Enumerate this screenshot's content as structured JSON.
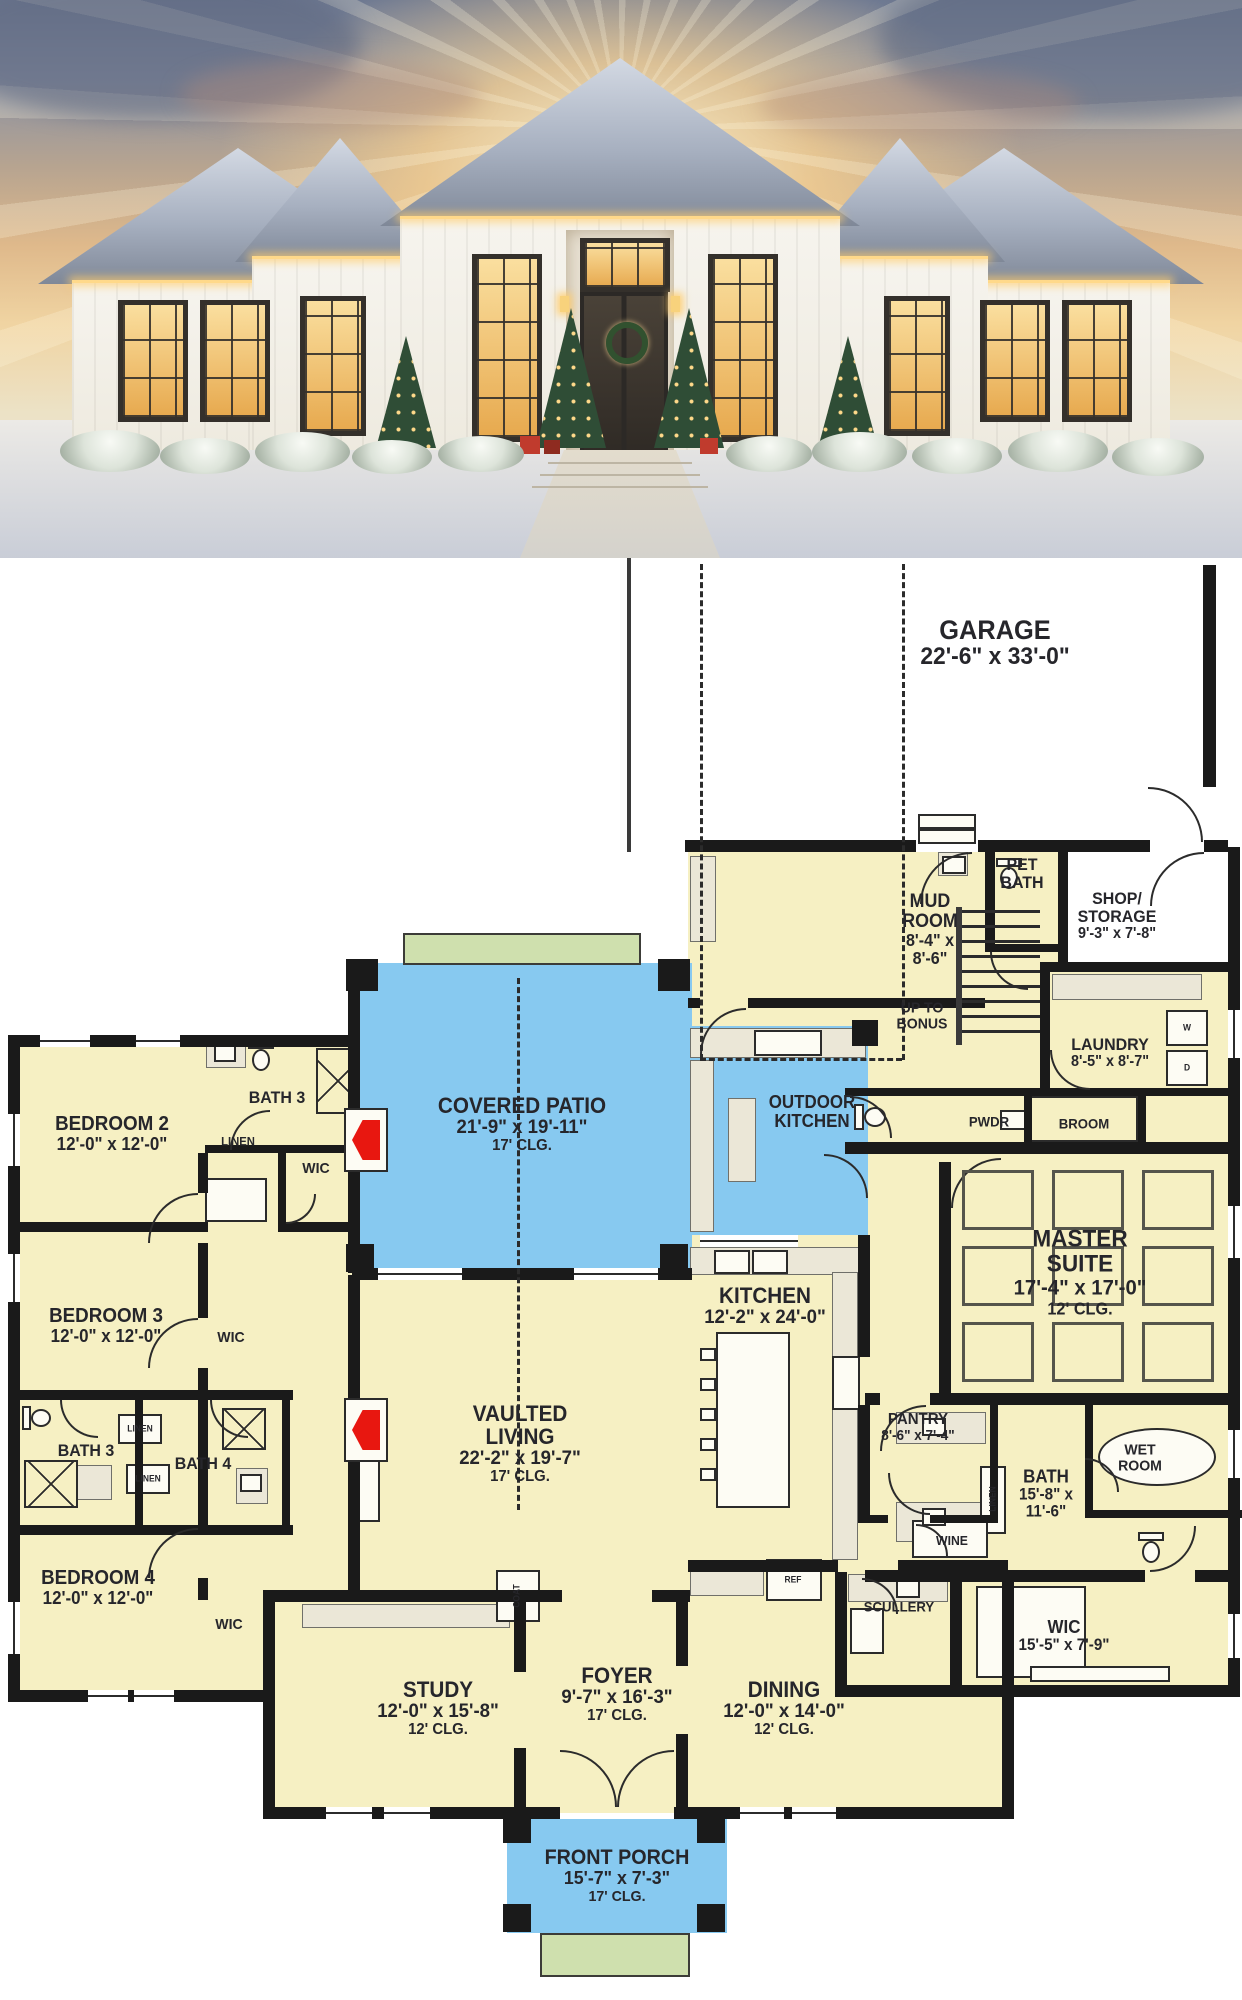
{
  "photo": {
    "alt": "snow-covered white modern farmhouse at sunset with glowing windows, roofline lights, christmas trees and snowy shrubs"
  },
  "plan": {
    "colors": {
      "room_fill": "#f6f0c3",
      "patio_fill": "#87c9f0",
      "steps_fill": "#cfe0ae",
      "wall": "#1a1a1a",
      "counter": "#ebe7d7",
      "fireplace_red": "#e81710",
      "label": "#26262b"
    },
    "room_labels": [
      {
        "id": "garage",
        "title": [
          "GARAGE"
        ],
        "dims": [
          "22'-6\" x 33'-0\""
        ],
        "clg": "",
        "x": 995,
        "y": 85,
        "fs": 27
      },
      {
        "id": "mud-room",
        "title": [
          "MUD",
          "ROOM"
        ],
        "dims": [
          "8'-4\" x",
          "8'-6\""
        ],
        "clg": "",
        "x": 930,
        "y": 372,
        "fs": 19
      },
      {
        "id": "pet-bath",
        "title": [
          "PET",
          "BATH"
        ],
        "dims": [],
        "clg": "",
        "x": 1022,
        "y": 316,
        "fs": 17
      },
      {
        "id": "shop-storage",
        "title": [
          "SHOP/",
          "STORAGE"
        ],
        "dims": [
          "9'-3\" x 7'-8\""
        ],
        "clg": "",
        "x": 1117,
        "y": 358,
        "fs": 17
      },
      {
        "id": "up-to-bonus",
        "title": [
          "UP TO",
          "BONUS"
        ],
        "dims": [],
        "clg": "",
        "x": 922,
        "y": 458,
        "fs": 15
      },
      {
        "id": "laundry",
        "title": [
          "LAUNDRY"
        ],
        "dims": [
          "8'-5\" x 8'-7\""
        ],
        "clg": "",
        "x": 1110,
        "y": 495,
        "fs": 17
      },
      {
        "id": "pwdr",
        "title": [
          "PWDR"
        ],
        "dims": [],
        "clg": "",
        "x": 989,
        "y": 564,
        "fs": 14
      },
      {
        "id": "broom",
        "title": [
          "BROOM"
        ],
        "dims": [],
        "clg": "",
        "x": 1084,
        "y": 566,
        "fs": 14
      },
      {
        "id": "master-suite",
        "title": [
          "MASTER",
          "SUITE"
        ],
        "dims": [
          "17'-4\" x 17'-0\""
        ],
        "clg": "12' CLG.",
        "x": 1080,
        "y": 714,
        "fs": 24
      },
      {
        "id": "outdoor-kitchen",
        "title": [
          "OUTDOOR",
          "KITCHEN"
        ],
        "dims": [],
        "clg": "",
        "x": 812,
        "y": 554,
        "fs": 18
      },
      {
        "id": "covered-patio",
        "title": [
          "COVERED PATIO"
        ],
        "dims": [
          "21'-9\" x 19'-11\""
        ],
        "clg": "17' CLG.",
        "x": 522,
        "y": 566,
        "fs": 22
      },
      {
        "id": "kitchen",
        "title": [
          "KITCHEN"
        ],
        "dims": [
          "12'-2\" x 24'-0\""
        ],
        "clg": "",
        "x": 765,
        "y": 748,
        "fs": 22
      },
      {
        "id": "vaulted-living",
        "title": [
          "VAULTED",
          "LIVING"
        ],
        "dims": [
          "22'-2\" x 19'-7\""
        ],
        "clg": "17' CLG.",
        "x": 520,
        "y": 886,
        "fs": 22
      },
      {
        "id": "bedroom-2",
        "title": [
          "BEDROOM 2"
        ],
        "dims": [
          "12'-0\" x 12'-0\""
        ],
        "clg": "",
        "x": 112,
        "y": 576,
        "fs": 20
      },
      {
        "id": "bath-3-upper",
        "title": [
          "BATH 3"
        ],
        "dims": [],
        "clg": "",
        "x": 277,
        "y": 540,
        "fs": 17
      },
      {
        "id": "linen-upper",
        "title": [
          "LINEN"
        ],
        "dims": [],
        "clg": "",
        "x": 238,
        "y": 584,
        "fs": 12
      },
      {
        "id": "wic-bed2",
        "title": [
          "WIC"
        ],
        "dims": [],
        "clg": "",
        "x": 316,
        "y": 611,
        "fs": 15
      },
      {
        "id": "bedroom-3",
        "title": [
          "BEDROOM 3"
        ],
        "dims": [
          "12'-0\" x 12'-0\""
        ],
        "clg": "",
        "x": 106,
        "y": 768,
        "fs": 20
      },
      {
        "id": "wic-bed3",
        "title": [
          "WIC"
        ],
        "dims": [],
        "clg": "",
        "x": 231,
        "y": 780,
        "fs": 15
      },
      {
        "id": "bath-3-lower",
        "title": [
          "BATH 3"
        ],
        "dims": [],
        "clg": "",
        "x": 86,
        "y": 893,
        "fs": 17
      },
      {
        "id": "bath-4",
        "title": [
          "BATH 4"
        ],
        "dims": [],
        "clg": "",
        "x": 203,
        "y": 906,
        "fs": 17
      },
      {
        "id": "linen-b",
        "title": [
          "LINEN"
        ],
        "dims": [],
        "clg": "",
        "x": 140,
        "y": 871,
        "fs": 9
      },
      {
        "id": "linen-c",
        "title": [
          "LINEN"
        ],
        "dims": [],
        "clg": "",
        "x": 148,
        "y": 921,
        "fs": 9
      },
      {
        "id": "bedroom-4",
        "title": [
          "BEDROOM 4"
        ],
        "dims": [
          "12'-0\" x 12'-0\""
        ],
        "clg": "",
        "x": 98,
        "y": 1030,
        "fs": 20
      },
      {
        "id": "wic-bed4",
        "title": [
          "WIC"
        ],
        "dims": [],
        "clg": "",
        "x": 229,
        "y": 1067,
        "fs": 15
      },
      {
        "id": "pantry",
        "title": [
          "PANTRY"
        ],
        "dims": [
          "8'-6\" x 7'-4\""
        ],
        "clg": "",
        "x": 918,
        "y": 870,
        "fs": 16
      },
      {
        "id": "wine",
        "title": [
          "WINE"
        ],
        "dims": [],
        "clg": "",
        "x": 952,
        "y": 983,
        "fs": 13
      },
      {
        "id": "linen-vert",
        "title": [
          "LINEN"
        ],
        "dims": [],
        "clg": "",
        "x": 993,
        "y": 941,
        "fs": 9,
        "rot": true
      },
      {
        "id": "master-bath",
        "title": [
          "BATH"
        ],
        "dims": [
          "15'-8\" x",
          "11'-6\""
        ],
        "clg": "",
        "x": 1046,
        "y": 936,
        "fs": 18
      },
      {
        "id": "wet-room",
        "title": [
          "WET",
          "ROOM"
        ],
        "dims": [],
        "clg": "",
        "x": 1140,
        "y": 900,
        "fs": 15
      },
      {
        "id": "wic-master",
        "title": [
          "WIC"
        ],
        "dims": [
          "15'-5\" x 7'-9\""
        ],
        "clg": "",
        "x": 1064,
        "y": 1078,
        "fs": 18
      },
      {
        "id": "scullery",
        "title": [
          "SCULLERY"
        ],
        "dims": [],
        "clg": "",
        "x": 899,
        "y": 1049,
        "fs": 14
      },
      {
        "id": "dining",
        "title": [
          "DINING"
        ],
        "dims": [
          "12'-0\" x 14'-0\""
        ],
        "clg": "12' CLG.",
        "x": 784,
        "y": 1150,
        "fs": 22
      },
      {
        "id": "foyer",
        "title": [
          "FOYER"
        ],
        "dims": [
          "9'-7\" x 16'-3\""
        ],
        "clg": "17' CLG.",
        "x": 617,
        "y": 1136,
        "fs": 22
      },
      {
        "id": "study",
        "title": [
          "STUDY"
        ],
        "dims": [
          "12'-0\" x 15'-8\""
        ],
        "clg": "12' CLG.",
        "x": 438,
        "y": 1150,
        "fs": 22
      },
      {
        "id": "front-porch",
        "title": [
          "FRONT PORCH"
        ],
        "dims": [
          "15'-7\" x 7'-3\""
        ],
        "clg": "17' CLG.",
        "x": 617,
        "y": 1318,
        "fs": 21
      },
      {
        "id": "ref",
        "title": [
          "REF"
        ],
        "dims": [],
        "clg": "",
        "x": 793,
        "y": 1022,
        "fs": 9
      },
      {
        "id": "coat",
        "title": [
          "COAT"
        ],
        "dims": [],
        "clg": "",
        "x": 517,
        "y": 1038,
        "fs": 9,
        "rot": true
      },
      {
        "id": "washer",
        "title": [
          "W"
        ],
        "dims": [],
        "clg": "",
        "x": 1187,
        "y": 470,
        "fs": 9
      },
      {
        "id": "dryer",
        "title": [
          "D"
        ],
        "dims": [],
        "clg": "",
        "x": 1187,
        "y": 510,
        "fs": 9
      }
    ]
  }
}
